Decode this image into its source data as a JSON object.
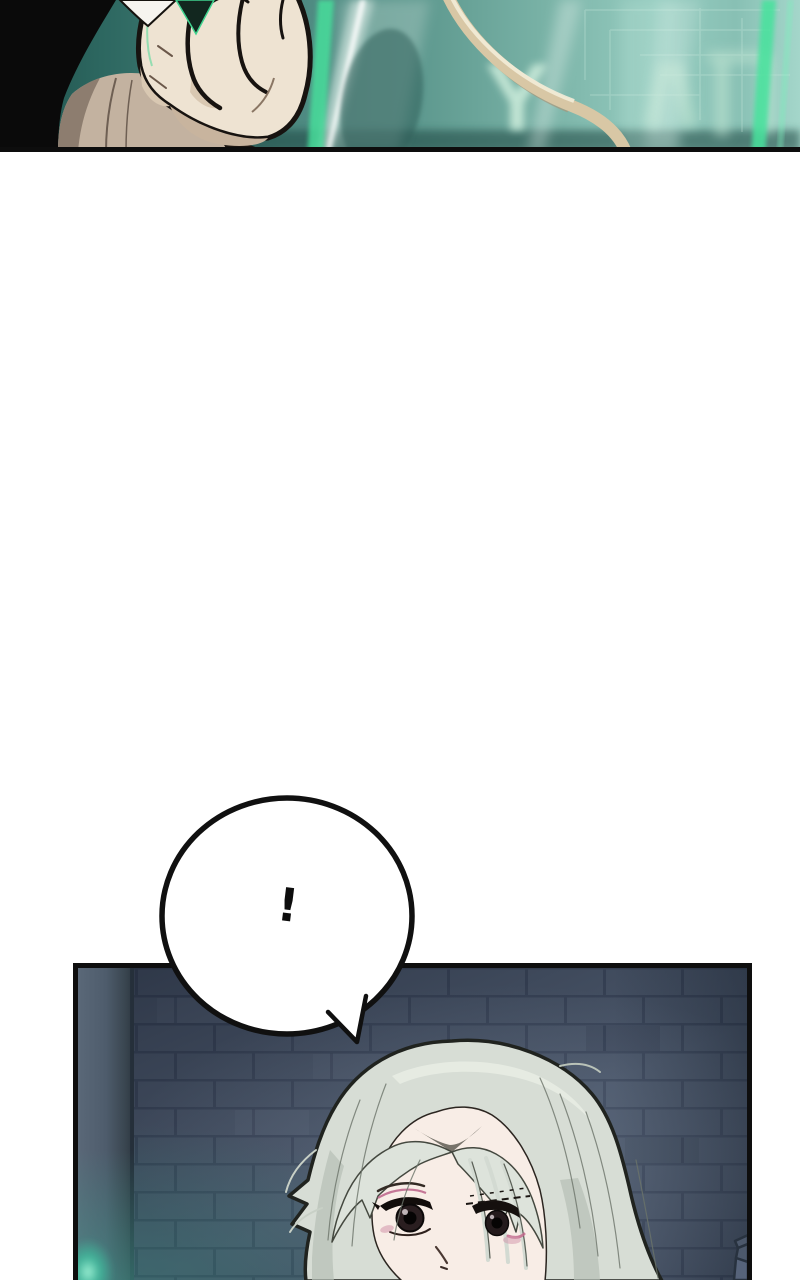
{
  "page": {
    "kind": "webtoon comic page",
    "width_px": 800,
    "height_px": 1280,
    "background": "#ffffff"
  },
  "panel_top": {
    "label": "close-up of clenched fist in front of glowing teal screen",
    "screen_glyph": "Y",
    "colors": {
      "screen_dark": "#1e4d48",
      "screen_mid": "#5d988e",
      "screen_light": "#a4d6ca",
      "glyph_mint": "#c9ead9",
      "energy_green": "#46e29c",
      "cable_tan": "#d8c7a5",
      "skin": "#eee3d2",
      "skin_shadow": "#c8b49e",
      "wrist": "#c3b2a0",
      "sleeve_black": "#0a0a0a",
      "cuff_white": "#f6f4ef",
      "outline": "#171310",
      "border": "#0d0d0d"
    }
  },
  "gutter": {
    "color": "#ffffff"
  },
  "speech_bubble": {
    "text": "!",
    "fill": "#ffffff",
    "stroke": "#101010"
  },
  "panel_bottom": {
    "label": "silver-haired character in front of dark brick wall",
    "colors": {
      "brick": "#4a5669",
      "mortar": "#3b465a",
      "pillar": "#4e5c6c",
      "pillar_edge": "#232d38",
      "teal_glow": "#59dcb8",
      "hair": "#d7ddd5",
      "hair_shadow": "#b6bfb5",
      "hair_outline": "#20231f",
      "skin": "#f8ede6",
      "eye_dark": "#241a1c",
      "eye_liner": "#120d0b",
      "pink_accent": "#c2678c",
      "border": "#0e0e0e"
    }
  }
}
